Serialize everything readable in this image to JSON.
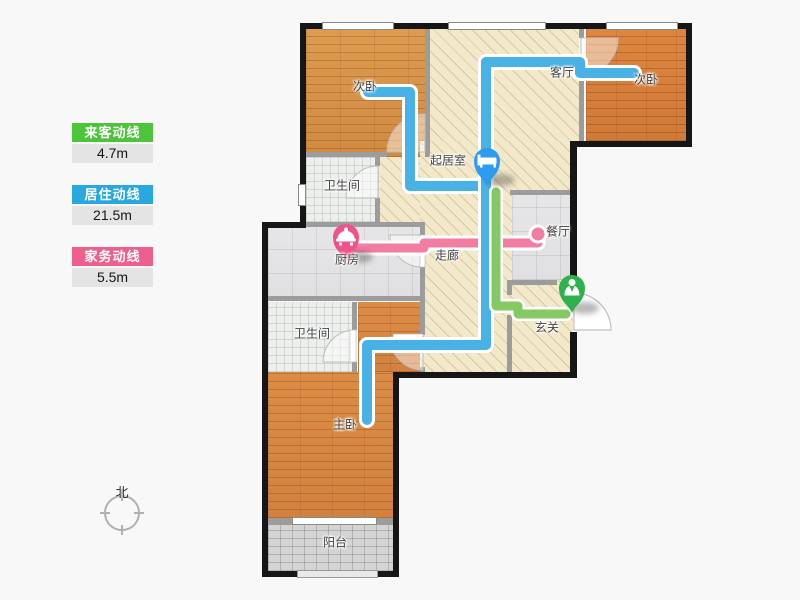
{
  "legend": {
    "items": [
      {
        "label": "来客动线",
        "value": "4.7m",
        "color": "#4ec43b"
      },
      {
        "label": "居住动线",
        "value": "21.5m",
        "color": "#29a8e0"
      },
      {
        "label": "家务动线",
        "value": "5.5m",
        "color": "#ef5f8b"
      }
    ]
  },
  "compass": {
    "label": "北"
  },
  "plan": {
    "rooms": {
      "bedroom_left": "次卧",
      "living": "客厅",
      "bedroom_right": "次卧",
      "sitting": "起居室",
      "bath_upper": "卫生间",
      "kitchen": "厨房",
      "corridor": "走廊",
      "dining": "餐厅",
      "entry": "玄关",
      "bath_lower": "卫生间",
      "master": "主卧",
      "balcony": "阳台"
    },
    "routes": {
      "resident_color": "#48b1e6",
      "guest_color": "#84c964",
      "chore_color": "#f27da2",
      "casing_color": "#ffffff"
    },
    "pins": {
      "bed_color": "#2d9bef",
      "pot_color": "#ef538a",
      "person_color": "#2fb14b",
      "glyph_color": "#ffffff"
    }
  }
}
